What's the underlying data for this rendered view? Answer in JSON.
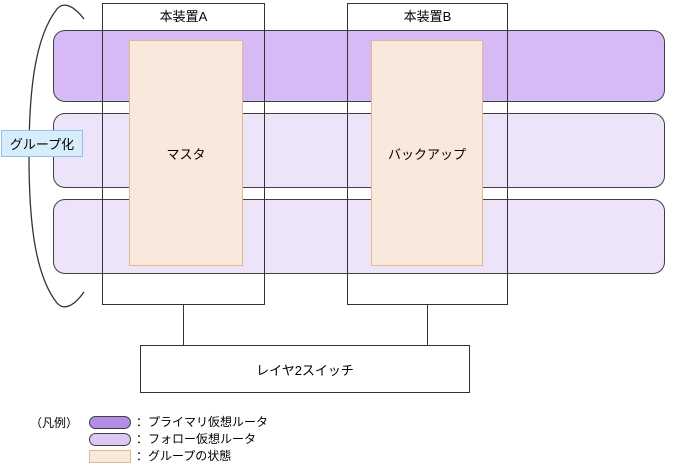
{
  "diagram": {
    "group_label": "グループ化",
    "devices": [
      {
        "title": "本装置A",
        "state": "マスタ"
      },
      {
        "title": "本装置B",
        "state": "バックアップ"
      }
    ],
    "bands": [
      {
        "label": "プライマリ仮想ルータ",
        "type": "primary"
      },
      {
        "label": "フォロー仮想ルータ1",
        "type": "follow"
      },
      {
        "label": "フォロー仮想ルータ2",
        "type": "follow"
      }
    ],
    "switch_label": "レイヤ2スイッチ"
  },
  "legend": {
    "title": "（凡例）",
    "items": [
      {
        "icon": "primary-virtual-router-swatch",
        "label": "：プライマリ仮想ルータ"
      },
      {
        "icon": "follow-virtual-router-swatch",
        "label": "：フォロー仮想ルータ"
      },
      {
        "icon": "group-state-swatch",
        "label": "：グループの状態"
      }
    ]
  },
  "colors": {
    "primary_band": "#d6baf6",
    "follow_band": "#ede4f9",
    "band_border": "#404040",
    "state_fill": "#f8e9dc",
    "state_border": "#e2b98d",
    "group_label_fill": "#d8edfb",
    "group_label_border": "#93c0e4",
    "legend_primary": "#b48ce5",
    "legend_follow": "#dcc8f4",
    "line": "#333333"
  }
}
